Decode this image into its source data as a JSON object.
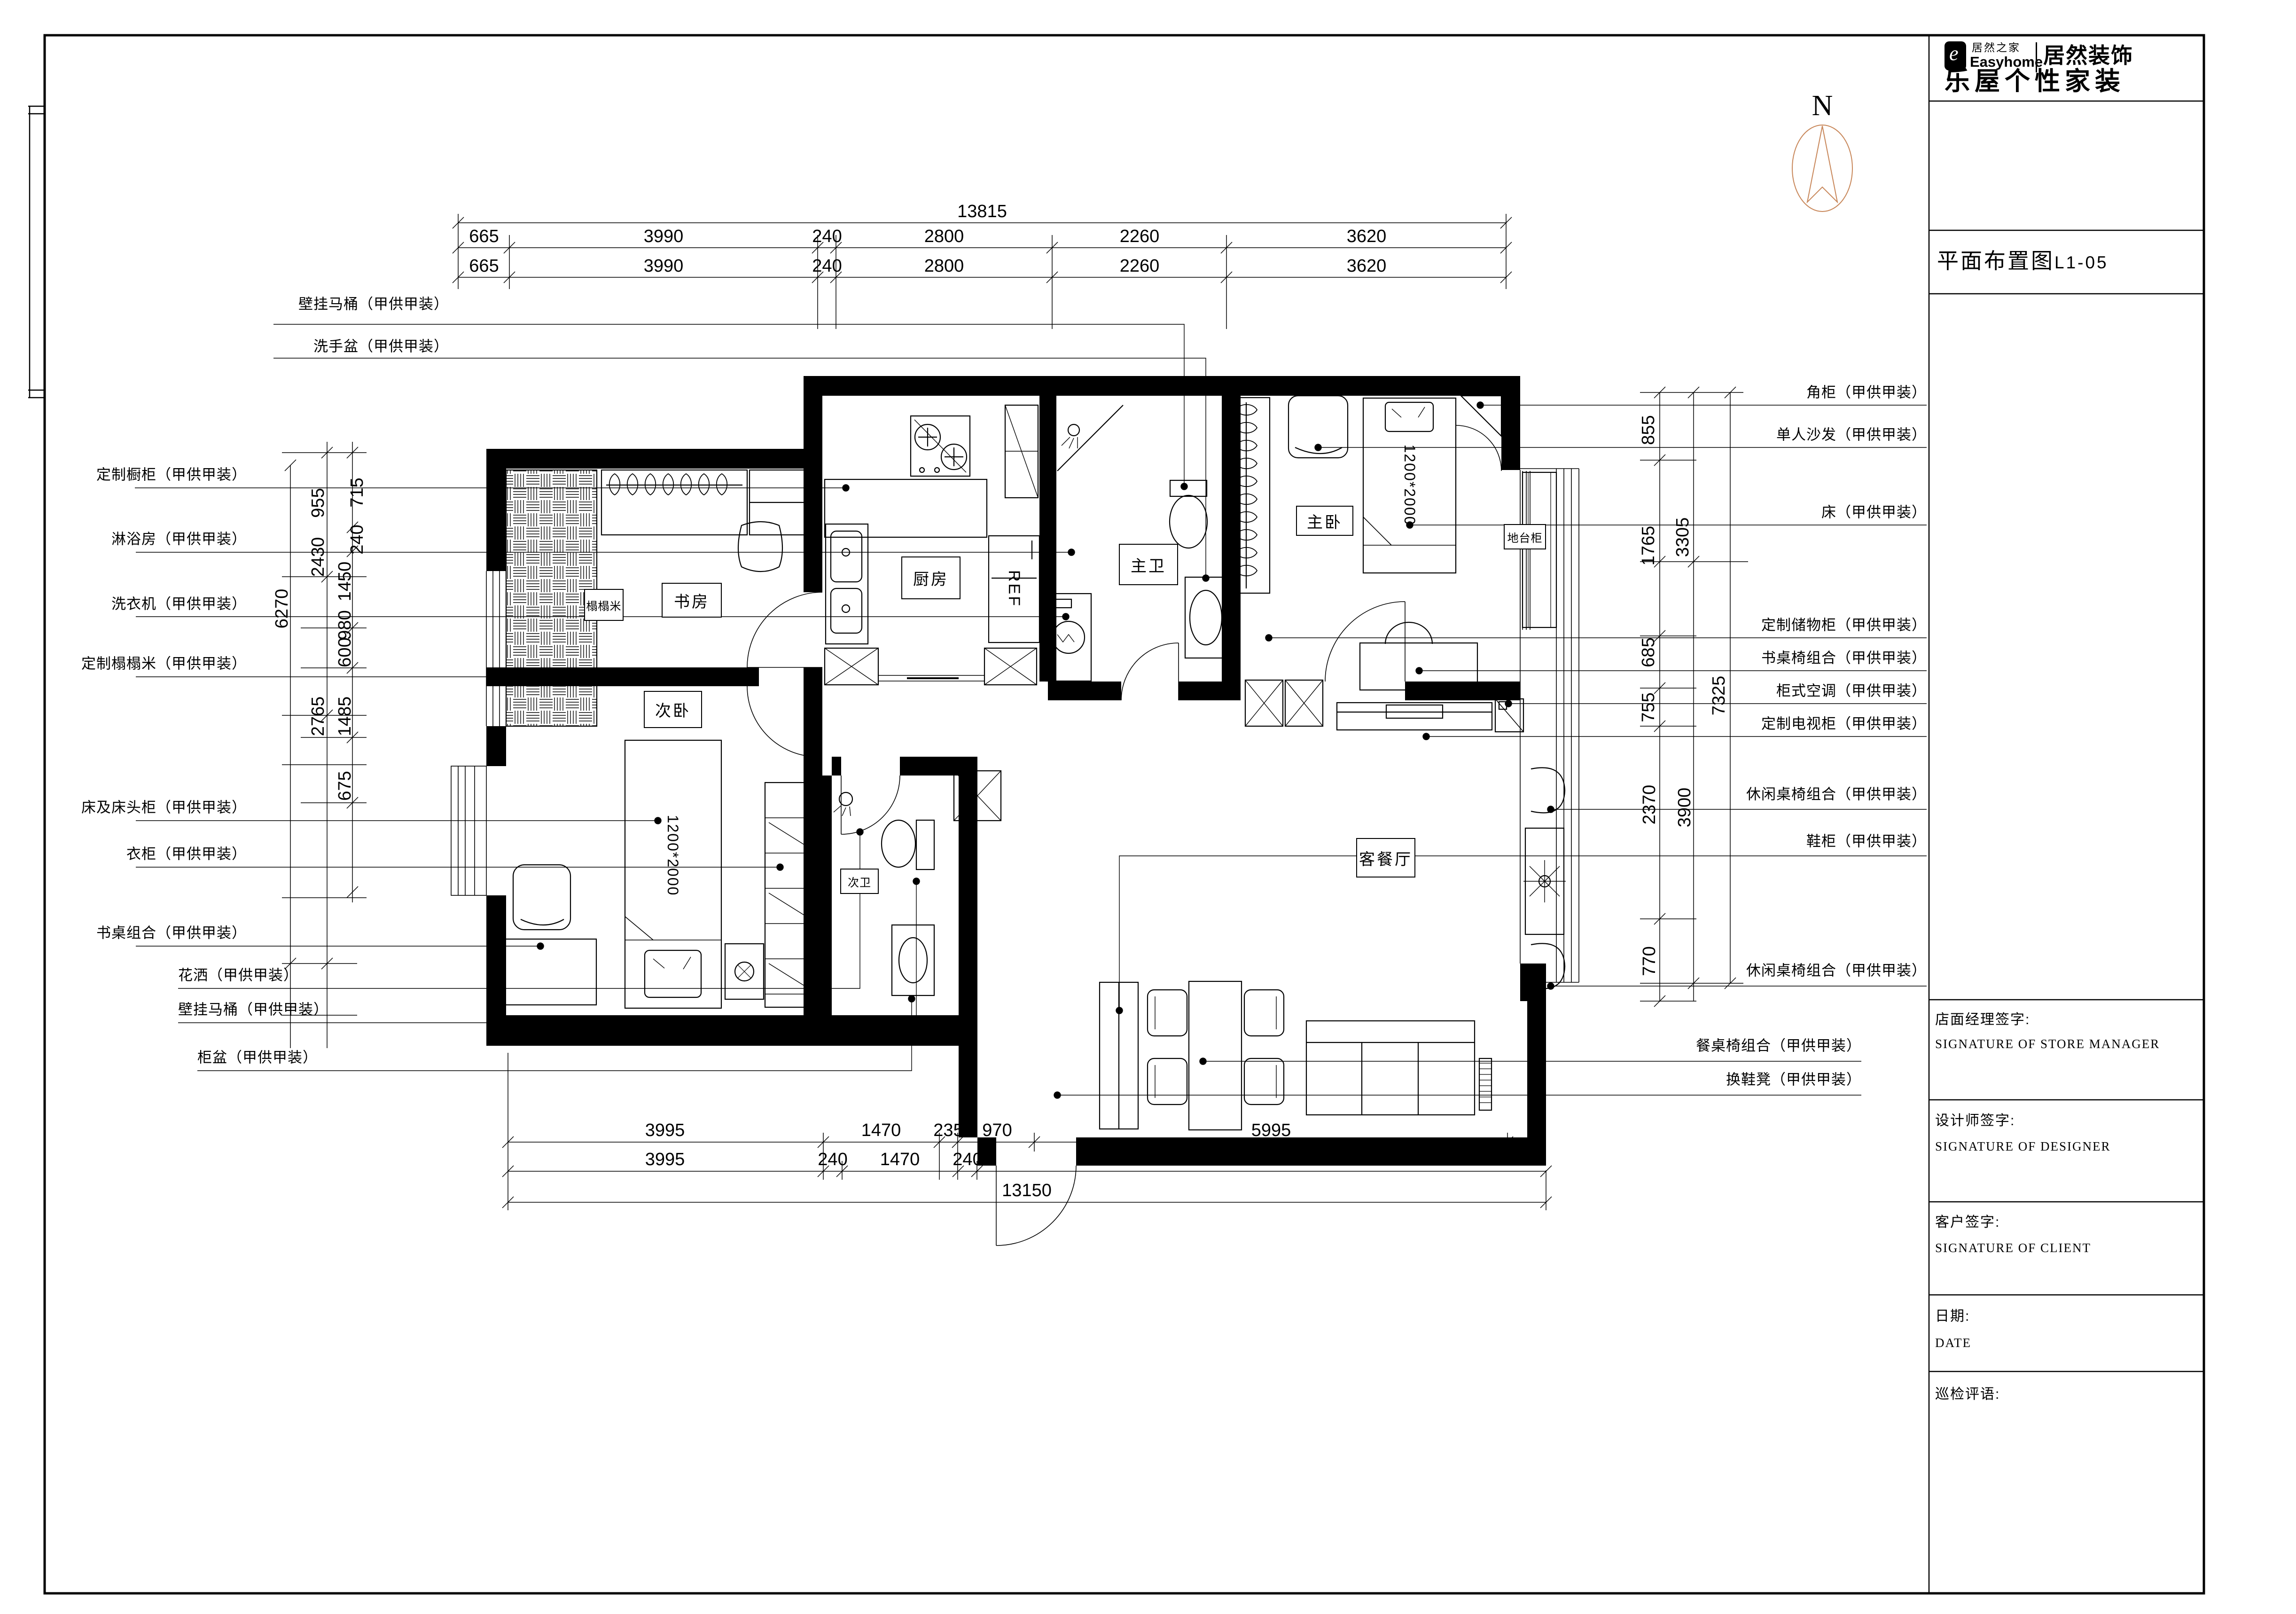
{
  "sheet": {
    "drawing_title": "平面布置图",
    "drawing_number": "L1-05"
  },
  "logo": {
    "brand_cn": "居然之家",
    "brand_en": "Easyhome",
    "division": "居然装饰",
    "slogan": "乐屋个性家装",
    "icon_letter": "e"
  },
  "north": {
    "label": "N"
  },
  "title_block": {
    "sections": [
      {
        "cn": "店面经理签字:",
        "en": "SIGNATURE OF STORE MANAGER"
      },
      {
        "cn": "设计师签字:",
        "en": "SIGNATURE OF DESIGNER"
      },
      {
        "cn": "客户签字:",
        "en": "SIGNATURE OF CLIENT"
      },
      {
        "cn": "日期:",
        "en": "DATE"
      },
      {
        "cn": "巡检评语:",
        "en": ""
      }
    ]
  },
  "rooms": {
    "study": "书房",
    "second_bedroom": "次卧",
    "kitchen": "厨房",
    "master_bath": "主卫",
    "master_bedroom": "主卧",
    "living_dining": "客餐厅",
    "second_bath": "次卫"
  },
  "annotations": {
    "tatami": "榻榻米",
    "platform_cabinet": "地台柜",
    "fridge": "REF",
    "master_bed_size": "1200*2000",
    "second_bed_size": "1200*2000"
  },
  "callouts_left": [
    "壁挂马桶（甲供甲装）",
    "洗手盆（甲供甲装）",
    "定制橱柜（甲供甲装）",
    "淋浴房（甲供甲装）",
    "洗衣机（甲供甲装）",
    "定制榻榻米（甲供甲装）",
    "床及床头柜（甲供甲装）",
    "衣柜（甲供甲装）",
    "书桌组合（甲供甲装）",
    "花洒（甲供甲装）",
    "壁挂马桶（甲供甲装）",
    "柜盆（甲供甲装）"
  ],
  "callouts_right": [
    "角柜（甲供甲装）",
    "单人沙发（甲供甲装）",
    "床（甲供甲装）",
    "定制储物柜（甲供甲装）",
    "书桌椅组合（甲供甲装）",
    "柜式空调（甲供甲装）",
    "定制电视柜（甲供甲装）",
    "休闲桌椅组合（甲供甲装）",
    "鞋柜（甲供甲装）",
    "休闲桌椅组合（甲供甲装）",
    "餐桌椅组合（甲供甲装）",
    "换鞋凳（甲供甲装）"
  ],
  "dimensions": {
    "top_total": "13815",
    "top_row1": [
      "665",
      "3990",
      "240",
      "2800",
      "2260",
      "3620"
    ],
    "top_row2": [
      "665",
      "3990",
      "240",
      "2800",
      "2260",
      "3620"
    ],
    "bottom_row1": [
      "3995",
      "1470",
      "235",
      "970",
      "5995"
    ],
    "bottom_row2": [
      "3995",
      "240",
      "1470",
      "240",
      "7205"
    ],
    "bottom_total": "13150",
    "left": [
      "955",
      "2430",
      "2765",
      "715",
      "240",
      "1450",
      "980",
      "600",
      "1485",
      "675",
      "6270"
    ],
    "right": [
      "855",
      "1765",
      "3305",
      "685",
      "755",
      "7325",
      "2370",
      "3900",
      "770"
    ]
  },
  "colors": {
    "line": "#000000",
    "north_arrow": "#c8875a"
  }
}
